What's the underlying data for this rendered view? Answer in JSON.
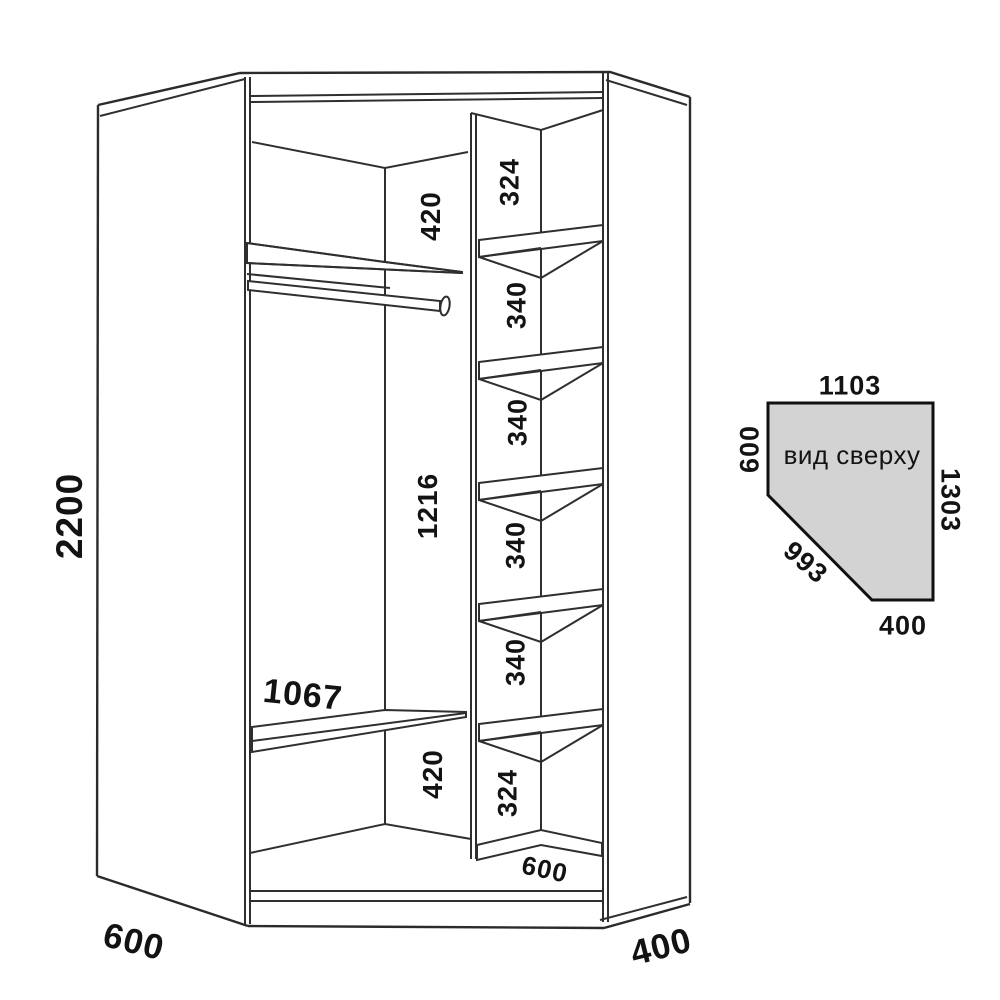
{
  "front_view": {
    "height_label": "2200",
    "depth_left_label": "600",
    "depth_right_label": "400",
    "shelf_width_label": "1067",
    "upper_gap_label": "420",
    "rail_section_label": "1216",
    "lower_gap_label": "420",
    "column_sections": [
      "324",
      "340",
      "340",
      "340",
      "340",
      "324"
    ],
    "column_depth_label": "600"
  },
  "top_view": {
    "title": "вид сверху",
    "top_label": "1103",
    "left_label": "600",
    "right_label": "1303",
    "diagonal_label": "993",
    "bottom_label": "400"
  },
  "colors": {
    "line": "#2f2f2f",
    "text": "#131313",
    "top_view_fill": "#d3d3d3",
    "background": "#ffffff"
  }
}
